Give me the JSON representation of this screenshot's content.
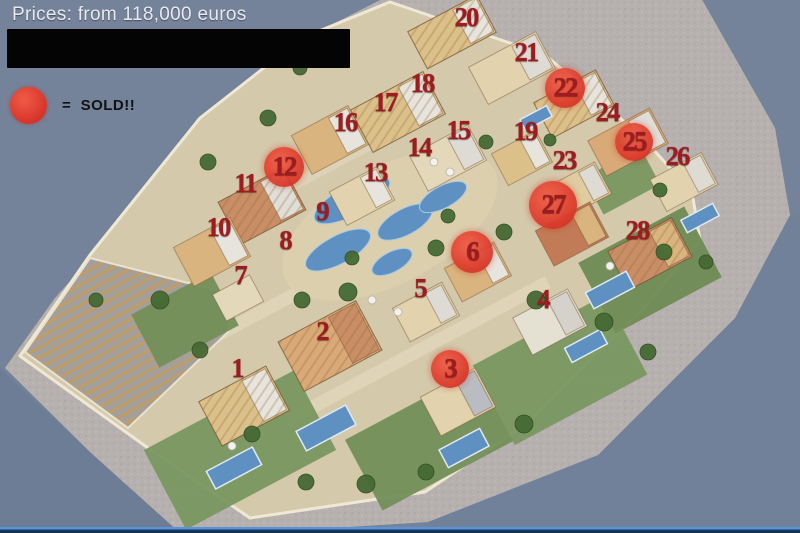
{
  "header": {
    "price_label": "Prices: from 118,000 euros"
  },
  "legend": {
    "marker": "red-circle",
    "label": "=  SOLD!!"
  },
  "site": {
    "sold_unit_numbers": [
      3,
      6,
      12,
      22,
      25,
      27
    ],
    "units": [
      {
        "n": "1",
        "x": 237,
        "y": 369,
        "sold": false
      },
      {
        "n": "2",
        "x": 322,
        "y": 332,
        "sold": false
      },
      {
        "n": "3",
        "x": 450,
        "y": 369,
        "sold": true,
        "r": 19
      },
      {
        "n": "4",
        "x": 543,
        "y": 300,
        "sold": false
      },
      {
        "n": "5",
        "x": 420,
        "y": 289,
        "sold": false
      },
      {
        "n": "6",
        "x": 472,
        "y": 252,
        "sold": true,
        "r": 21
      },
      {
        "n": "7",
        "x": 240,
        "y": 276,
        "sold": false
      },
      {
        "n": "8",
        "x": 285,
        "y": 241,
        "sold": false
      },
      {
        "n": "9",
        "x": 322,
        "y": 212,
        "sold": false
      },
      {
        "n": "10",
        "x": 218,
        "y": 228,
        "sold": false
      },
      {
        "n": "11",
        "x": 245,
        "y": 184,
        "sold": false
      },
      {
        "n": "12",
        "x": 284,
        "y": 167,
        "sold": true,
        "r": 20
      },
      {
        "n": "13",
        "x": 375,
        "y": 173,
        "sold": false
      },
      {
        "n": "14",
        "x": 419,
        "y": 148,
        "sold": false
      },
      {
        "n": "15",
        "x": 458,
        "y": 131,
        "sold": false
      },
      {
        "n": "16",
        "x": 345,
        "y": 123,
        "sold": false
      },
      {
        "n": "17",
        "x": 385,
        "y": 103,
        "sold": false
      },
      {
        "n": "18",
        "x": 422,
        "y": 84,
        "sold": false
      },
      {
        "n": "19",
        "x": 525,
        "y": 132,
        "sold": false
      },
      {
        "n": "20",
        "x": 466,
        "y": 18,
        "sold": false
      },
      {
        "n": "21",
        "x": 526,
        "y": 53,
        "sold": false
      },
      {
        "n": "22",
        "x": 565,
        "y": 88,
        "sold": true,
        "r": 20
      },
      {
        "n": "23",
        "x": 564,
        "y": 161,
        "sold": false
      },
      {
        "n": "24",
        "x": 607,
        "y": 113,
        "sold": false
      },
      {
        "n": "25",
        "x": 634,
        "y": 142,
        "sold": true,
        "r": 19
      },
      {
        "n": "26",
        "x": 677,
        "y": 157,
        "sold": false
      },
      {
        "n": "27",
        "x": 553,
        "y": 205,
        "sold": true,
        "r": 24
      },
      {
        "n": "28",
        "x": 637,
        "y": 231,
        "sold": false
      }
    ]
  },
  "colors": {
    "number_red": "#9d1c20",
    "sold_circle_red": "#d9362b",
    "background_sea": "#75839a",
    "beach_gray": "#b6b1ae",
    "land_sand": "#d5c9ab",
    "pool_blue": "#5e90c1",
    "grass_green": "#7a9760"
  }
}
